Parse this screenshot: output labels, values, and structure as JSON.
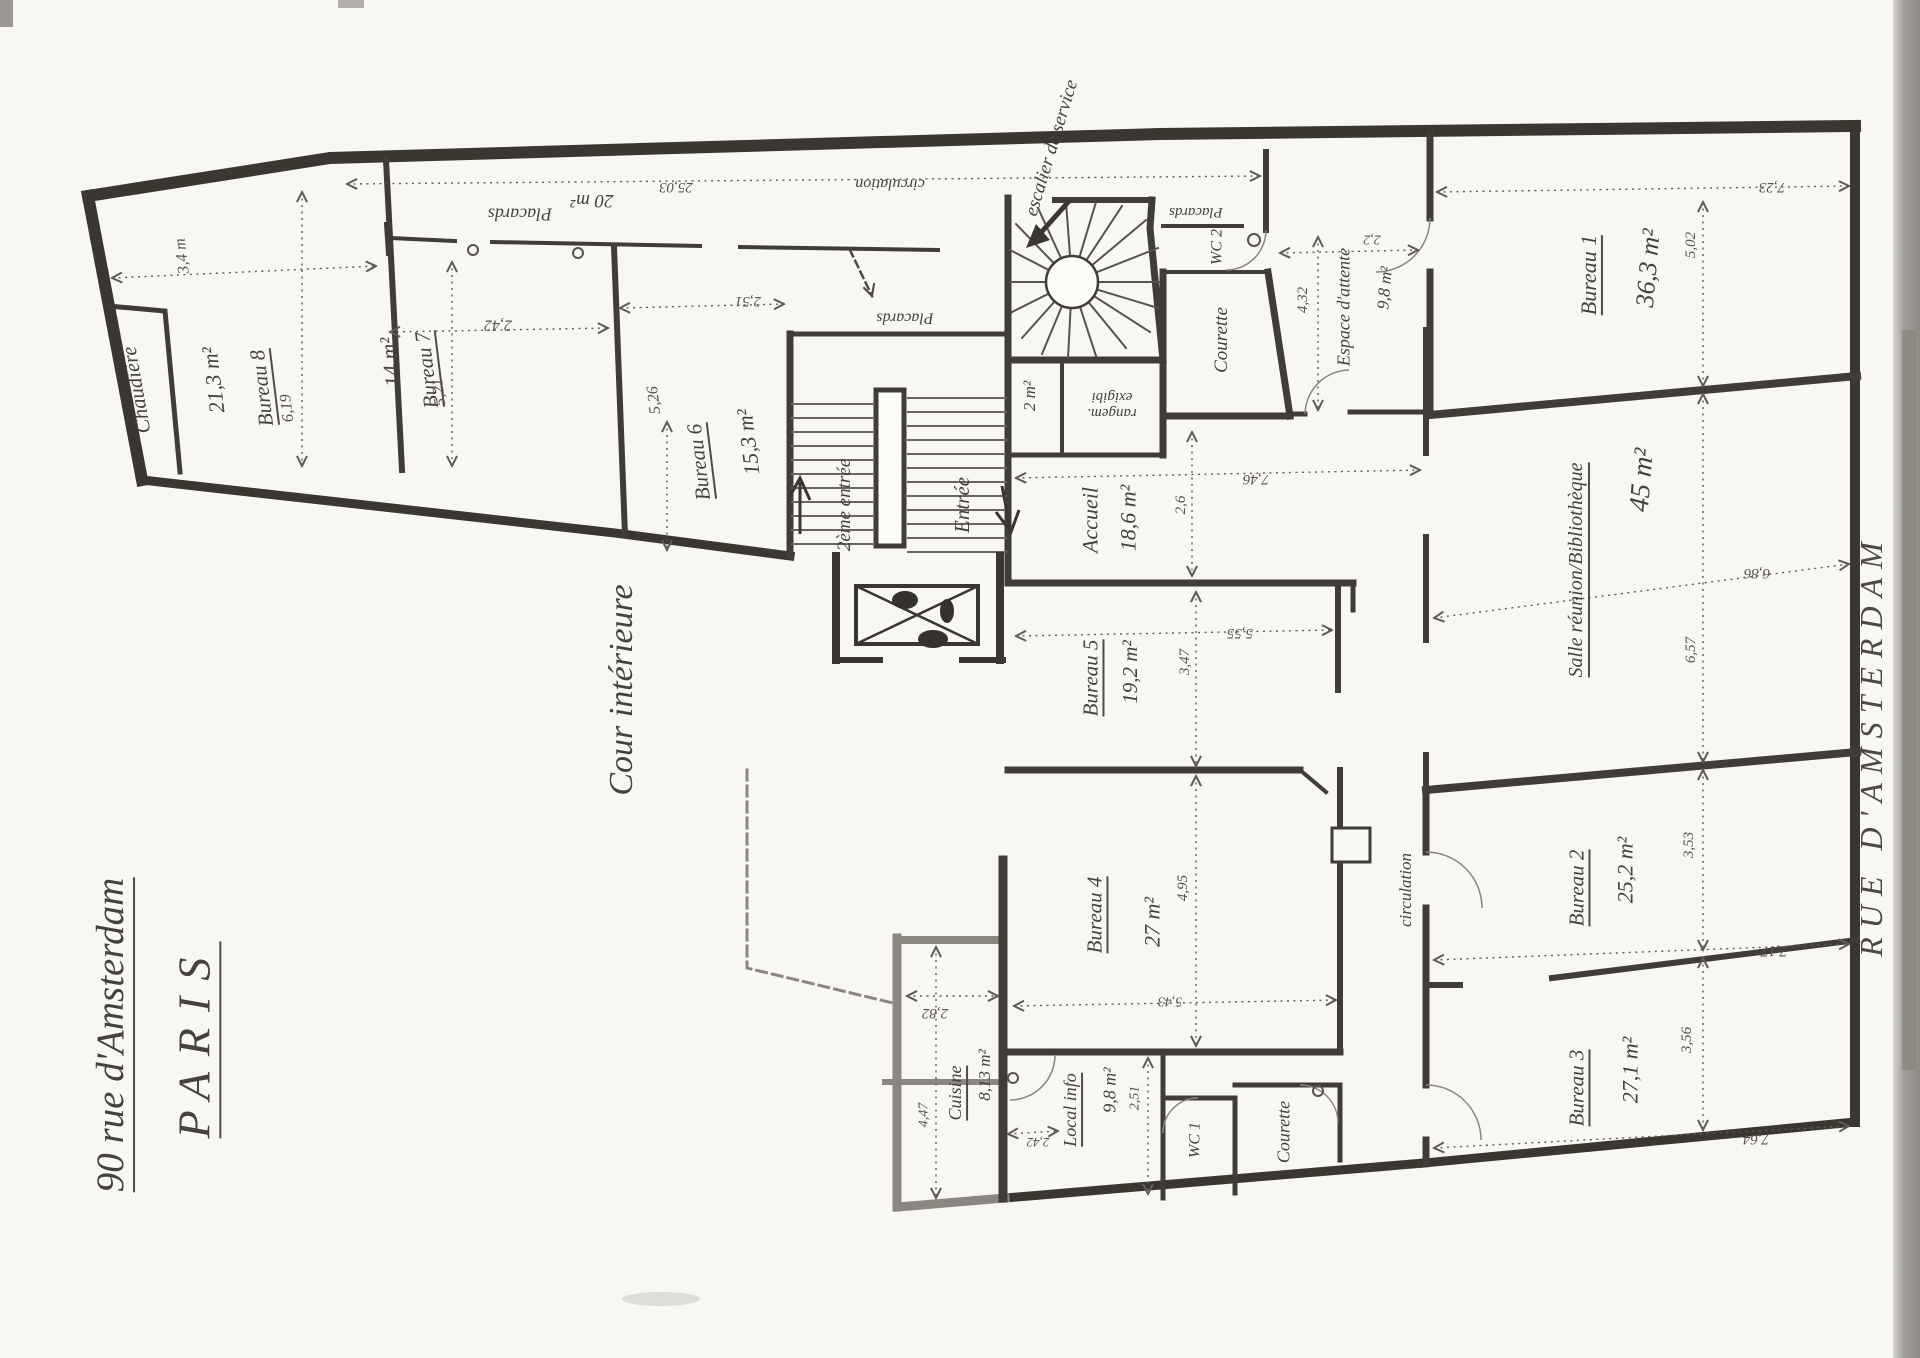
{
  "meta": {
    "title_line1": "90 rue d'Amsterdam",
    "title_line2": "PARIS",
    "street": "RUE D'AMSTERDAM",
    "courtyard": "Cour intérieure"
  },
  "rooms": {
    "chaudiere": {
      "name": "Chaudière"
    },
    "bureau8": {
      "name": "Bureau 8",
      "area": "21,3 m²"
    },
    "bureau7": {
      "name": "Bureau 7",
      "area": "14 m²"
    },
    "bureau6": {
      "name": "Bureau 6",
      "area": "15,3 m²"
    },
    "placards_couloir": {
      "name": "Placards",
      "area": "20 m²"
    },
    "placards_palier": {
      "name": "Placards"
    },
    "placards_service": {
      "name": "Placards"
    },
    "wc2": {
      "name": "WC 2"
    },
    "courette_haut": {
      "name": "Courette"
    },
    "espace_attente": {
      "name": "Espace d'attente",
      "area": "9,8 m²"
    },
    "bureau1": {
      "name": "Bureau 1",
      "area": "36,3 m²"
    },
    "rangement": {
      "line1": "rangem.",
      "line2": "exigibi",
      "area": "2 m²"
    },
    "accueil": {
      "name": "Accueil",
      "area": "18,6 m²"
    },
    "bureau5": {
      "name": "Bureau 5",
      "area": "19,2 m²"
    },
    "salle": {
      "name": "Salle réunion/Bibliothèque",
      "area": "45 m²"
    },
    "bureau2": {
      "name": "Bureau 2",
      "area": "25,2 m²"
    },
    "bureau4": {
      "name": "Bureau 4",
      "area": "27 m²"
    },
    "bureau3": {
      "name": "Bureau 3",
      "area": "27,1 m²"
    },
    "local_info": {
      "name": "Local info",
      "area": "9,8 m²"
    },
    "wc1": {
      "name": "WC 1"
    },
    "courette_bas": {
      "name": "Courette"
    },
    "cuisine": {
      "name": "Cuisine",
      "area": "8,13 m²"
    }
  },
  "circulation": {
    "top": "circulation",
    "middle": "circulation"
  },
  "stairs": {
    "service": "escalier de service"
  },
  "entrances": {
    "main": "Entrée",
    "secondary": "2ème entrée"
  },
  "dimensions": {
    "d619": "6,19",
    "d34": "3,4 m",
    "d242": "2,42",
    "d521": "5,21",
    "d2503": "25,03",
    "d526": "5,26",
    "d251": "2,51",
    "d723": "7,23",
    "d502": "5,02",
    "d432": "4,32",
    "d22": "2,2",
    "d746": "7,46",
    "d26": "2,6",
    "d555": "5,55",
    "d347": "3,47",
    "d657": "6,57",
    "d686": "6,86",
    "d353": "3,53",
    "d717": "7,17",
    "d495": "4,95",
    "d282": "2,82",
    "d356": "3,56",
    "d764": "7,64",
    "d543": "5,43",
    "d251b": "2,51",
    "d242b": "2,42",
    "d447": "4,47"
  }
}
